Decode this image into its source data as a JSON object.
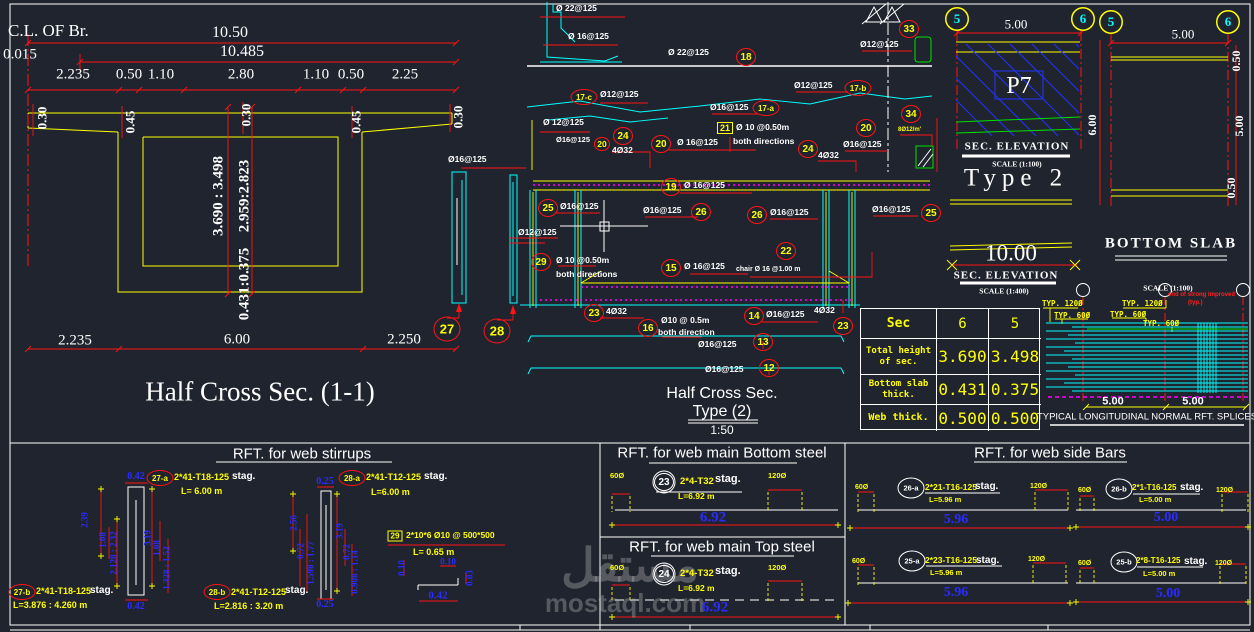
{
  "watermark": {
    "ar": "مستقل",
    "en": "mostaql.com"
  },
  "left": {
    "cl": "C.L. OF Br.",
    "d1": "10.50",
    "d2": "0.015",
    "d3": "10.485",
    "seg": [
      "2.235",
      "0.50",
      "1.10",
      "2.80",
      "1.10",
      "0.50",
      "2.25"
    ],
    "v1": "0.30",
    "v2": "0.45",
    "v3": "0.30",
    "v4": "0.45",
    "v5": "0.30",
    "h1": "3.690 : 3.498",
    "h2": "2.959:2.823",
    "h3": "0.431:0.375",
    "b1": "2.235",
    "b2": "6.00",
    "b3": "2.250",
    "title": "Half Cross Sec. (1-1)"
  },
  "bars": {
    "n27": "27",
    "n28": "28",
    "top": "Ø16@125",
    "side": "Ø12@125"
  },
  "mid": {
    "title1": "Half Cross Sec.",
    "title2": "Type (2)",
    "scale": "1:50",
    "par1": "Ø 22@125",
    "par2": "Ø 16@125",
    "par3": "Ø 12@125",
    "n18": "18",
    "l18": "Ø 22@125",
    "n17c": "17-c",
    "l17c": "Ø12@125",
    "n17a": "17-a",
    "l17a": "Ø16@125",
    "n17b": "17-b",
    "l17b": "Ø12@125",
    "n33": "33",
    "l33": "Ø12@125",
    "n20a": "20",
    "l20a": "Ø16@125",
    "n24a": "24",
    "l24a": "4Ø32",
    "n20b": "20",
    "l20b": "Ø 16@125",
    "n21": "21",
    "l21": "Ø 10 @0.50m",
    "l21b": "both directions",
    "n24b": "24",
    "l24b": "4Ø32",
    "n20c": "20",
    "l20c": "Ø16@125",
    "n34": "34",
    "l34": "8Ø12/m'",
    "n19": "19",
    "l19": "Ø 16@125",
    "n25a": "25",
    "l25a": "Ø16@125",
    "n26a": "26",
    "l26a": "Ø16@125",
    "n26b": "26",
    "l26b": "Ø16@125",
    "n25b": "25",
    "l25b": "Ø16@125",
    "n29": "29",
    "l29": "Ø 10 @0.50m",
    "l29b": "both directions",
    "n22": "22",
    "l22": "chair Ø 16 @1.00 m",
    "n15": "15",
    "l15": "Ø 16@125",
    "n23a": "23",
    "l23a": "4Ø32",
    "n16": "16",
    "l16": "Ø10 @ 0.5m",
    "l16b": "both direction",
    "n14": "14",
    "l14": "Ø16@125",
    "n23b": "23",
    "l23b": "4Ø32",
    "n13": "13",
    "l13": "Ø16@125",
    "n12": "12",
    "l12": "Ø16@125"
  },
  "right": {
    "g5a": "5",
    "g6a": "6",
    "g5b": "5",
    "g6b": "6",
    "dim5a": "5.00",
    "dim5b": "5.00",
    "p7": "P7",
    "secelev1": "SEC. ELEVATION",
    "scale1": "SCALE (1:100)",
    "d6": "6.00",
    "type2": "Type 2",
    "d10": "10.00",
    "secelev2": "SEC. ELEVATION",
    "scale2": "SCALE (1:400)",
    "d05a": "0.50",
    "d5r": "5.00",
    "d05b": "0.50",
    "bslab": "BOTTOM SLAB",
    "scale3": "SCALE (1:100)"
  },
  "table": {
    "h0": "Sec",
    "h1": "6",
    "h2": "5",
    "r1l": "Total height of sec.",
    "r1a": "3.690",
    "r1b": "3.498",
    "r2l": "Bottom slab thick.",
    "r2a": "0.431",
    "r2b": "0.375",
    "r3l": "Web thick.",
    "r3a": "0.500",
    "r3b": "0.500"
  },
  "splices": {
    "t120a": "TYP. 120Ø",
    "t60a": "TYP. 60Ø",
    "t120b": "TYP. 120Ø",
    "t60b": "TYP. 60Ø",
    "t60c": "TYP. 60Ø",
    "note1": "end of strong improved",
    "note2": "(typ.)",
    "d5a": "5.00",
    "d5b": "5.00",
    "title": "TYPICAL LONGITUDINAL NORMAL RFT. SPLICES"
  },
  "p1": {
    "header": "RFT. for web stirrups",
    "a_top": "0.42",
    "a_bot": "0.42",
    "b_top": "0.25",
    "b_bot": "0.25",
    "n27a": "27-a",
    "t27a": "2*41-T18-125",
    "s27a": "stag.",
    "L27a": "L= 6.00 m",
    "n27b": "27-b",
    "t27b": "2*41-T18-125",
    "s27b": "stag.",
    "L27b": "L=3.876 : 4.260 m",
    "n28a": "28-a",
    "t28a": "2*41-T12-125",
    "s28a": "stag.",
    "L28a": "L=6.00 m",
    "n28b": "28-b",
    "t28b": "2*41-T12-125",
    "s28b": "stag.",
    "L28b": "L=2.816 : 3.20 m",
    "ad1": "2.39",
    "ad2": "1.08",
    "ad3": "2.128 : 2.32",
    "ad4": "3.19",
    "ad5": "1.08",
    "ad6": "1.328 : 1.52",
    "bd1": "2.56",
    "bd2": "0.72",
    "bd3": "1.598 : 1.77",
    "bd4": "3.19",
    "bd5": "0.72",
    "bd6": "0.908 : 1.14",
    "n29": "29",
    "t29": "2*10*6 Ø10 @ 500*500",
    "L29": "L= 0.65 m",
    "d29a": "0.10",
    "d29b": "0.10",
    "d29c": "0.42",
    "d29d": "0.03"
  },
  "p2": {
    "header1": "RFT. for web main Bottom steel",
    "header2": "RFT. for web main Top steel",
    "d60": "60Ø",
    "d120": "120Ø",
    "n23": "23",
    "t23": "2*4-T32",
    "s23": "stag.",
    "L23": "L=6.92 m",
    "dim23": "6.92",
    "n24": "24",
    "t24": "2*4-T32",
    "s24": "stag.",
    "L24": "L=6.92 m",
    "dim24": "6.92"
  },
  "p3": {
    "header": "RFT. for web side Bars",
    "d60": "60Ø",
    "d120": "120Ø",
    "n26a": "26-a",
    "t26a": "2*21-T16-125",
    "s26a": "stag.",
    "L26a": "L=5.96 m",
    "dim26a": "5.96",
    "n26b": "26-b",
    "t26b": "2*1-T16-125",
    "s26b": "stag.",
    "L26b": "L=5.00 m",
    "dim26b": "5.00",
    "n25a": "25-a",
    "t25a": "2*23-T16-125",
    "s25a": "stag.",
    "L25a": "L=5.96 m",
    "dim25a": "5.96",
    "n25b": "25-b",
    "t25b": "2*8-T16-125",
    "s25b": "stag.",
    "L25b": "L=5.00 m",
    "dim25b": "5.00"
  }
}
